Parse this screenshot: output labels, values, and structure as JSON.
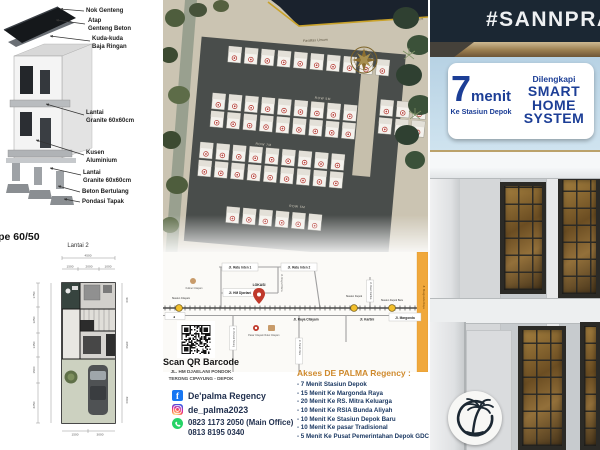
{
  "brand": {
    "hashtag": "#SANNPRA"
  },
  "left_panel": {
    "labels": [
      "Nok Genteng",
      "Atap\nGenteng Beton",
      "Kuda-kuda\nBaja Ringan",
      "Lantai\nGranite 60x60cm",
      "Kusen\nAluminium",
      "Lantai\nGranite 60x60cm",
      "Beton Bertulang",
      "Pondasi Tapak"
    ],
    "type_label": "Tipe 60/50",
    "floorplan": {
      "title": "Lantai 2",
      "dim_total_top": "4500",
      "dim_top": [
        "1500",
        "2000",
        "1000"
      ],
      "dim_left": [
        "1750",
        "1250",
        "1450",
        "1500",
        "2250"
      ],
      "dim_right": [
        "900",
        "2850",
        "3800"
      ],
      "dim_bottom": [
        "1500",
        "3000"
      ]
    }
  },
  "site_plan": {
    "fasilitas": "Fasilitas Umum",
    "future": "Future Development",
    "rows": [
      "ROW 5M",
      "ROW 7M",
      "ROW 5M"
    ]
  },
  "map": {
    "street_ratu_inten_1": "Jl. Ratu Inten 1",
    "street_ratu_inten_2": "Jl. Ratu Inten 2",
    "street_hm_djaelani": "Jl. HM Djaelani",
    "street_raya_pitara": "Jl. Raya Pitara",
    "street_raya_citayam": "Jl. Raya Citayam",
    "street_kartini": "Jl. Kartini",
    "street_margonda": "Jl. Margonda",
    "street_dewi_sartika": "Jl. Dewi Sartika",
    "street_pondok_terong": "Jl. Pondok Terong",
    "street_tanah_baru": "Jl. Tanah Baru",
    "street_margonda_raya": "Jl. Margonda Raya",
    "west_arrow": "◄",
    "lokasi": "LOKASI",
    "station_citayam": "Stasiun Citayam",
    "station_depok": "Stasiun Depok",
    "station_depok_baru": "Stasiun Depok Baru",
    "poi_pasar": "Pasar Citayam",
    "poi_ruko": "Ruko Citayam",
    "poi_kuliner": "Kuliner Citayam"
  },
  "contact": {
    "scan_label": "Scan QR Barcode",
    "address_line1": "JL. HM DJAELANI PONDOK",
    "address_line2": "TERONG CIPAYUNG - DEPOK",
    "facebook": "De'palma Regency",
    "instagram": "de_palma2023",
    "phone_main": "0823 1173 2050 (Main Office)",
    "phone_alt": "0813 8195 0340"
  },
  "akses": {
    "title": "Akses DE PALMA Regency :",
    "items": [
      "- 7 Menit Stasiun Depok",
      "- 15 Menit Ke Margonda Raya",
      "- 20 Menit Ke RS. Mitra Keluarga",
      "- 10 Menit Ke RSIA Bunda Aliyah",
      "- 10 Menit Ke Stasiun Depok Baru",
      "- 10 Menit Ke pasar Tradisional",
      "- 5 Menit Ke Pusat Pemerintahan Depok GDC"
    ]
  },
  "badge": {
    "minutes": "7",
    "menit": "menit",
    "sub": "Ke Stasiun Depok",
    "equipped": "Dilengkapi",
    "lines": "SMART\nHOME\nSYSTEM"
  },
  "colors": {
    "navy": "#1b2733",
    "badge_blue": "#1c3e96",
    "akses_orange": "#cf8a2d",
    "gold": "#c9a22a",
    "station_yellow": "#f3c02c",
    "pin_red": "#c0392b",
    "toll_orange": "#f0a83c",
    "facebook_blue": "#1877f2",
    "whatsapp_green": "#25d366"
  }
}
